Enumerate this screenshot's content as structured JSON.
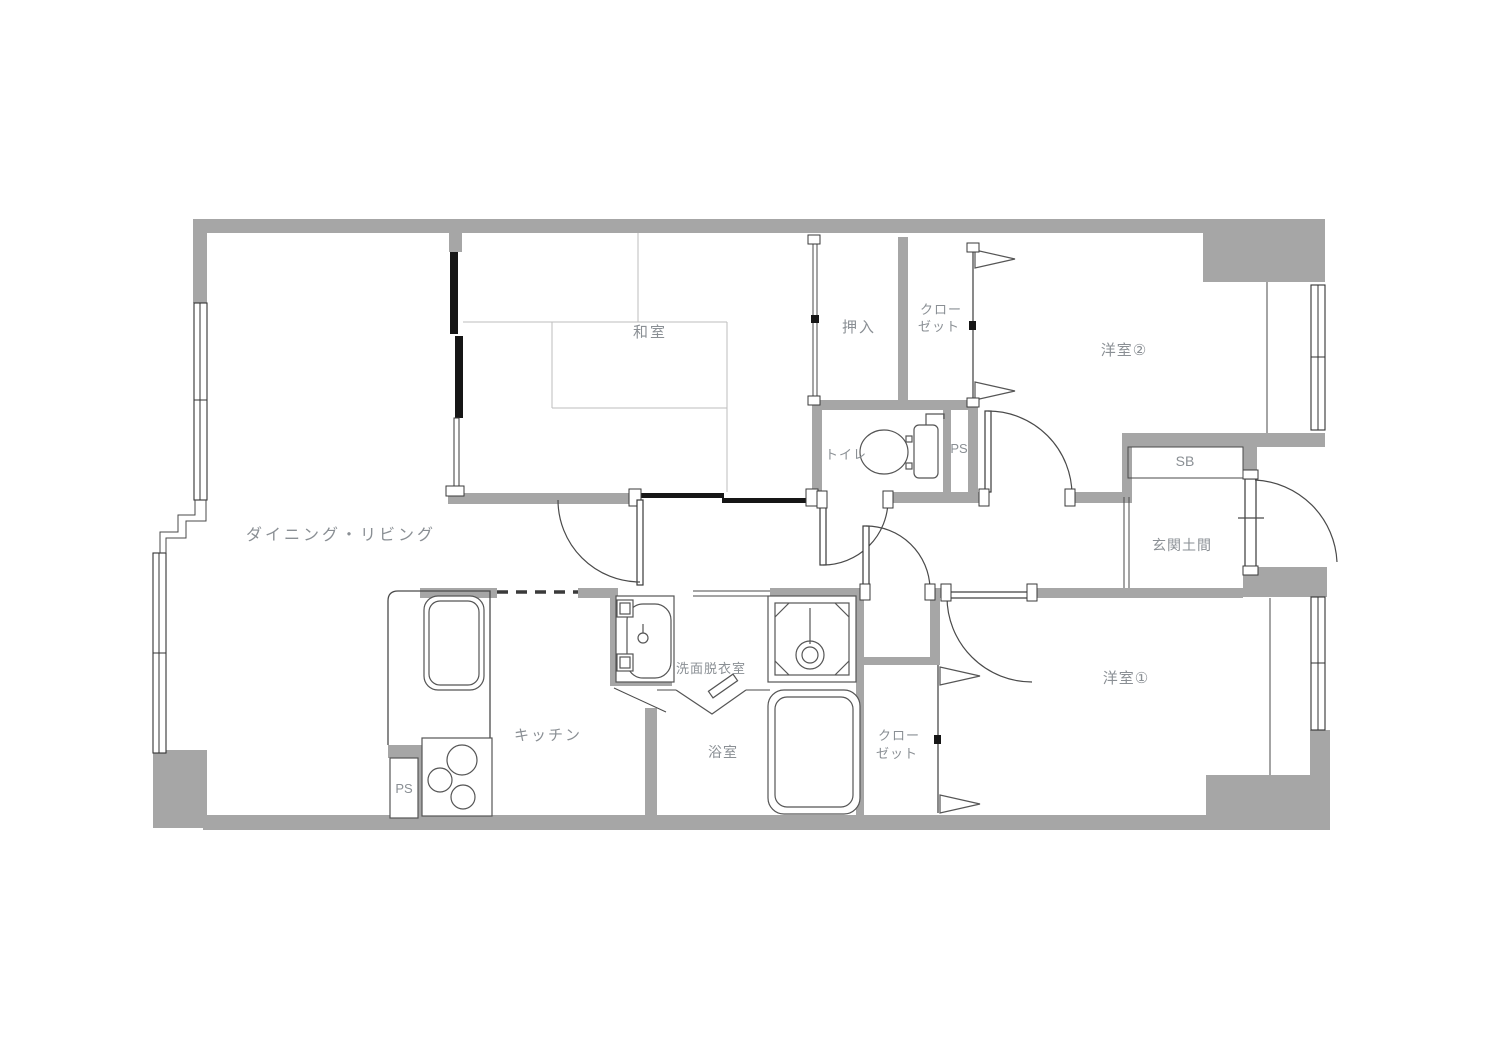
{
  "plan": {
    "colors": {
      "wall": "#a6a6a6",
      "outline": "#4a4a4a",
      "fixture": "#555555",
      "tatami": "#bdbdbd",
      "label": "#8a8f94",
      "sliding_door": "#161616",
      "background": "#ffffff"
    },
    "labels": {
      "living": "ダイニング・リビング",
      "washitsu": "和室",
      "oshiire": "押入",
      "closet_a_line1": "クロー",
      "closet_a_line2": "ゼット",
      "yoshitsu2": "洋室②",
      "toilet": "トイレ",
      "ps_a": "PS",
      "sb": "SB",
      "genkan": "玄関土間",
      "yoshitsu1": "洋室①",
      "senmen": "洗面脱衣室",
      "kitchen": "キッチン",
      "bath": "浴室",
      "closet_b_line1": "クロー",
      "closet_b_line2": "ゼット",
      "ps_b": "PS"
    },
    "fixtures": {
      "toilet": "toilet-bowl-and-tank",
      "bathtub": "bathtub",
      "vanity": "washbasin-vanity",
      "washer_pan": "washing-machine-pan",
      "kitchen_sink": "kitchen-sink",
      "stove": "three-burner-stove"
    }
  }
}
